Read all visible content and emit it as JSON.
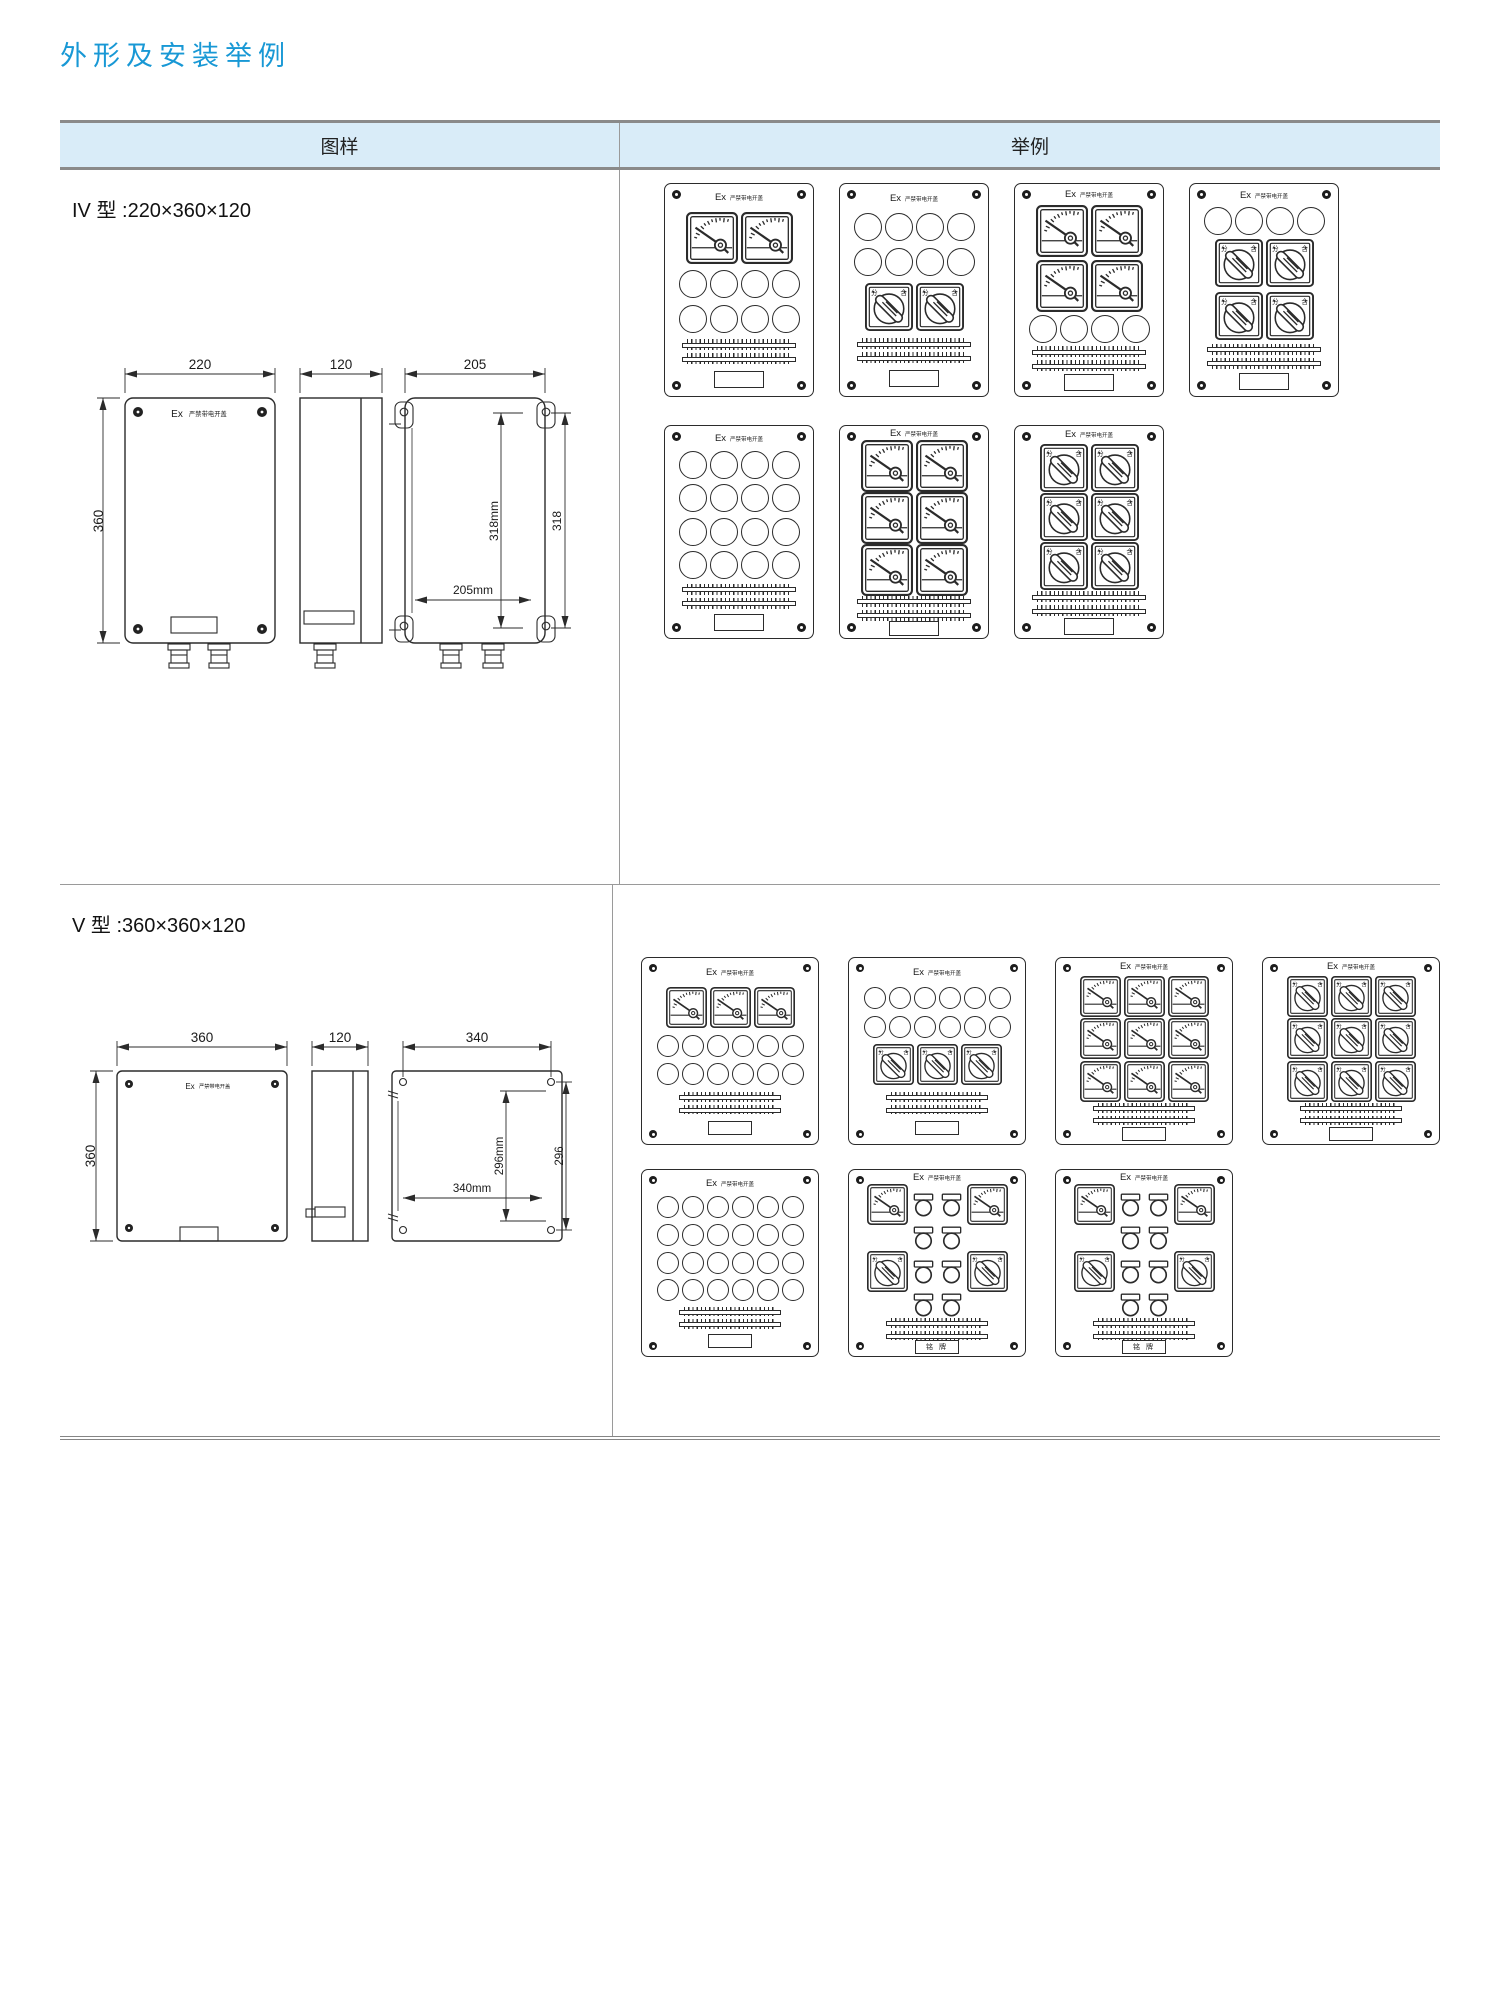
{
  "title": "外形及安装举例",
  "table": {
    "headers": {
      "pattern": "图样",
      "example": "举例"
    }
  },
  "panel_header": {
    "ex": "Ex",
    "warning": "严禁带电开盖"
  },
  "switch_labels": {
    "open": "分",
    "close": "合"
  },
  "rows": [
    {
      "id": "iv",
      "type_label": "IV 型 :220×360×120",
      "drawing": {
        "front_width": "220",
        "front_height": "360",
        "side_width": "120",
        "rear_width": "205",
        "rear_inner_height": "318mm",
        "rear_outer_height": "318",
        "rear_inner_width": "205mm"
      },
      "panel_groups": [
        [
          {
            "rows": [
              [
                "meter",
                "meter"
              ],
              [
                "circle",
                "circle",
                "circle",
                "circle"
              ],
              [
                "circle",
                "circle",
                "circle",
                "circle"
              ]
            ]
          },
          {
            "rows": [
              [
                "circle",
                "circle",
                "circle",
                "circle"
              ],
              [
                "circle",
                "circle",
                "circle",
                "circle"
              ],
              [
                "switch",
                "switch"
              ]
            ]
          },
          {
            "rows": [
              [
                "meter",
                "meter"
              ],
              [
                "meter",
                "meter"
              ],
              [
                "circle",
                "circle",
                "circle",
                "circle"
              ]
            ]
          },
          {
            "rows": [
              [
                "circle",
                "circle",
                "circle",
                "circle"
              ],
              [
                "switch",
                "switch"
              ],
              [
                "switch",
                "switch"
              ]
            ]
          }
        ],
        [
          {
            "rows": [
              [
                "circle",
                "circle",
                "circle",
                "circle"
              ],
              [
                "circle",
                "circle",
                "circle",
                "circle"
              ],
              [
                "circle",
                "circle",
                "circle",
                "circle"
              ],
              [
                "circle",
                "circle",
                "circle",
                "circle"
              ]
            ]
          },
          {
            "rows": [
              [
                "meter",
                "meter"
              ],
              [
                "meter",
                "meter"
              ],
              [
                "meter",
                "meter"
              ]
            ]
          },
          {
            "rows": [
              [
                "switch",
                "switch"
              ],
              [
                "switch",
                "switch"
              ],
              [
                "switch",
                "switch"
              ]
            ]
          }
        ]
      ]
    },
    {
      "id": "v",
      "type_label": "V 型 :360×360×120",
      "drawing": {
        "front_width": "360",
        "front_height": "360",
        "side_width": "120",
        "rear_width": "340",
        "rear_inner_height": "296mm",
        "rear_outer_height": "296",
        "rear_inner_width": "340mm"
      },
      "panel_groups": [
        [
          {
            "rows": [
              [
                "meter",
                "meter",
                "meter"
              ],
              [
                "circle",
                "circle",
                "circle",
                "circle",
                "circle",
                "circle"
              ],
              [
                "circle",
                "circle",
                "circle",
                "circle",
                "circle",
                "circle"
              ]
            ]
          },
          {
            "rows": [
              [
                "circle",
                "circle",
                "circle",
                "circle",
                "circle",
                "circle"
              ],
              [
                "circle",
                "circle",
                "circle",
                "circle",
                "circle",
                "circle"
              ],
              [
                "switch",
                "switch",
                "switch"
              ]
            ]
          },
          {
            "rows": [
              [
                "meter",
                "meter",
                "meter"
              ],
              [
                "meter",
                "meter",
                "meter"
              ],
              [
                "meter",
                "meter",
                "meter"
              ]
            ]
          },
          {
            "rows": [
              [
                "switch",
                "switch",
                "switch"
              ],
              [
                "switch",
                "switch",
                "switch"
              ],
              [
                "switch",
                "switch",
                "switch"
              ]
            ]
          }
        ],
        [
          {
            "rows": [
              [
                "circle",
                "circle",
                "circle",
                "circle",
                "circle",
                "circle"
              ],
              [
                "circle",
                "circle",
                "circle",
                "circle",
                "circle",
                "circle"
              ],
              [
                "circle",
                "circle",
                "circle",
                "circle",
                "circle",
                "circle"
              ],
              [
                "circle",
                "circle",
                "circle",
                "circle",
                "circle",
                "circle"
              ]
            ]
          },
          {
            "rows": [
              [
                "meter",
                "lamp",
                "lamp",
                "meter"
              ],
              [
                "lamp",
                "lamp"
              ],
              [
                "switch",
                "lamp",
                "lamp",
                "switch"
              ],
              [
                "lamp",
                "lamp"
              ]
            ],
            "plate_text": "铭 牌"
          },
          {
            "rows": [
              [
                "meter",
                "lamp",
                "lamp",
                "meter"
              ],
              [
                "lamp",
                "lamp"
              ],
              [
                "switch",
                "lamp",
                "lamp",
                "switch"
              ],
              [
                "lamp",
                "lamp"
              ]
            ],
            "plate_text": "铭 牌"
          }
        ]
      ]
    }
  ]
}
